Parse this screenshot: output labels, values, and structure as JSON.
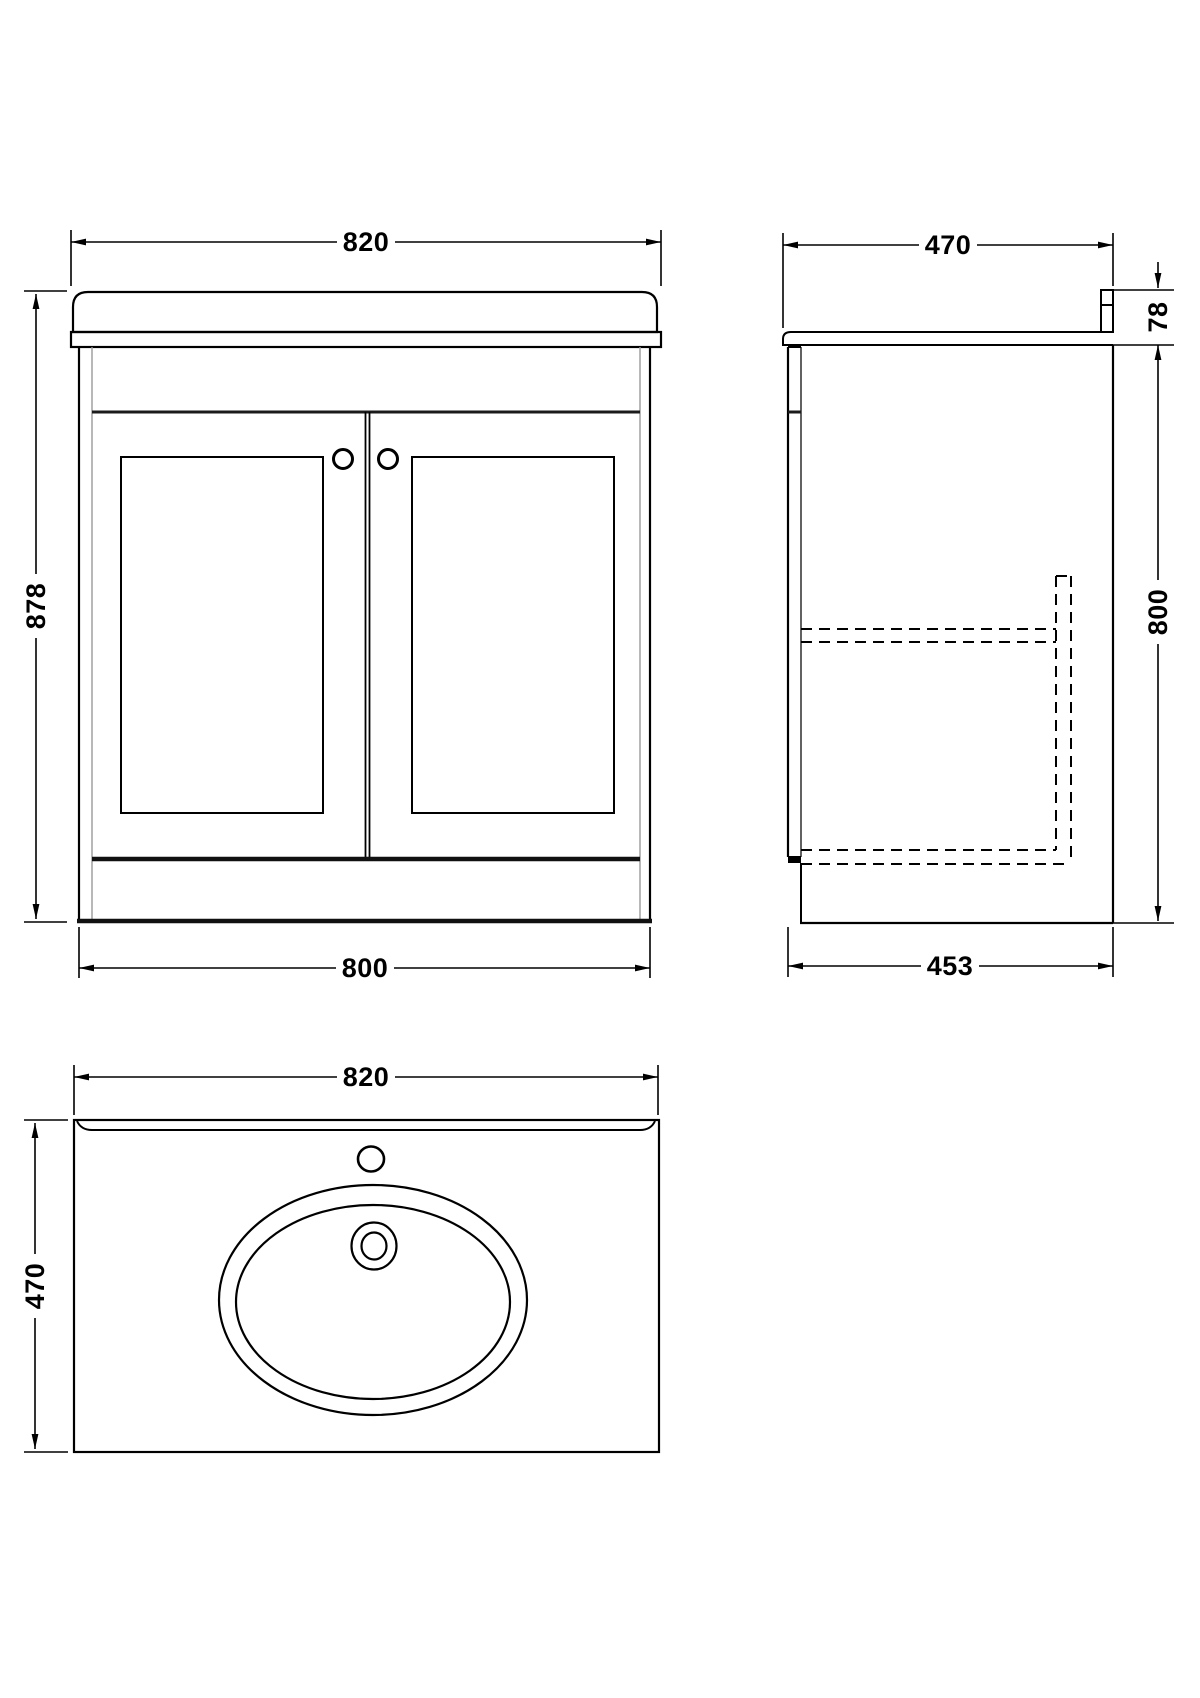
{
  "views": {
    "front": {
      "dim_width_top": "820",
      "dim_height_left": "878",
      "dim_width_bottom": "800"
    },
    "side": {
      "dim_depth_top": "470",
      "dim_worktop_height": "78",
      "dim_cabinet_height": "800",
      "dim_depth_bottom": "453"
    },
    "plan": {
      "dim_width_top": "820",
      "dim_depth_left": "470"
    }
  },
  "colors": {
    "line": "#000000",
    "thin_line": "#9a9a9a",
    "background": "#ffffff"
  }
}
